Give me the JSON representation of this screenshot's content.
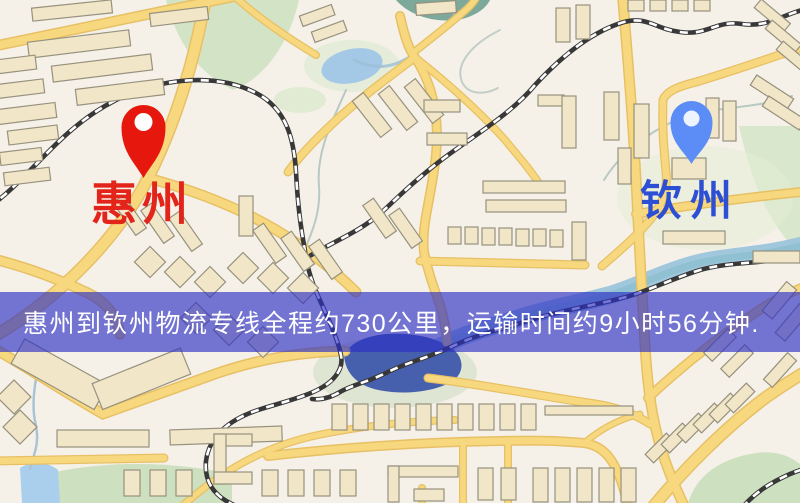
{
  "banner": {
    "text": "惠州到钦州物流专线全程约730公里，运输时间约9小时56分钟.",
    "background_hex": "#2d2fc4",
    "background_rgba": "rgba(45,47,196,0.65)",
    "text_color": "#ffffff"
  },
  "markers": {
    "origin": {
      "label": "惠州",
      "pin_color": "#e6170c",
      "label_color": "#e2241a"
    },
    "destination": {
      "label": "钦州",
      "pin_color": "#5c8cf5",
      "label_color": "#2d4fd4"
    }
  },
  "route": {
    "origin": "惠州",
    "destination": "钦州",
    "distance_text": "约730公里",
    "duration_text": "约9小时56分钟"
  }
}
